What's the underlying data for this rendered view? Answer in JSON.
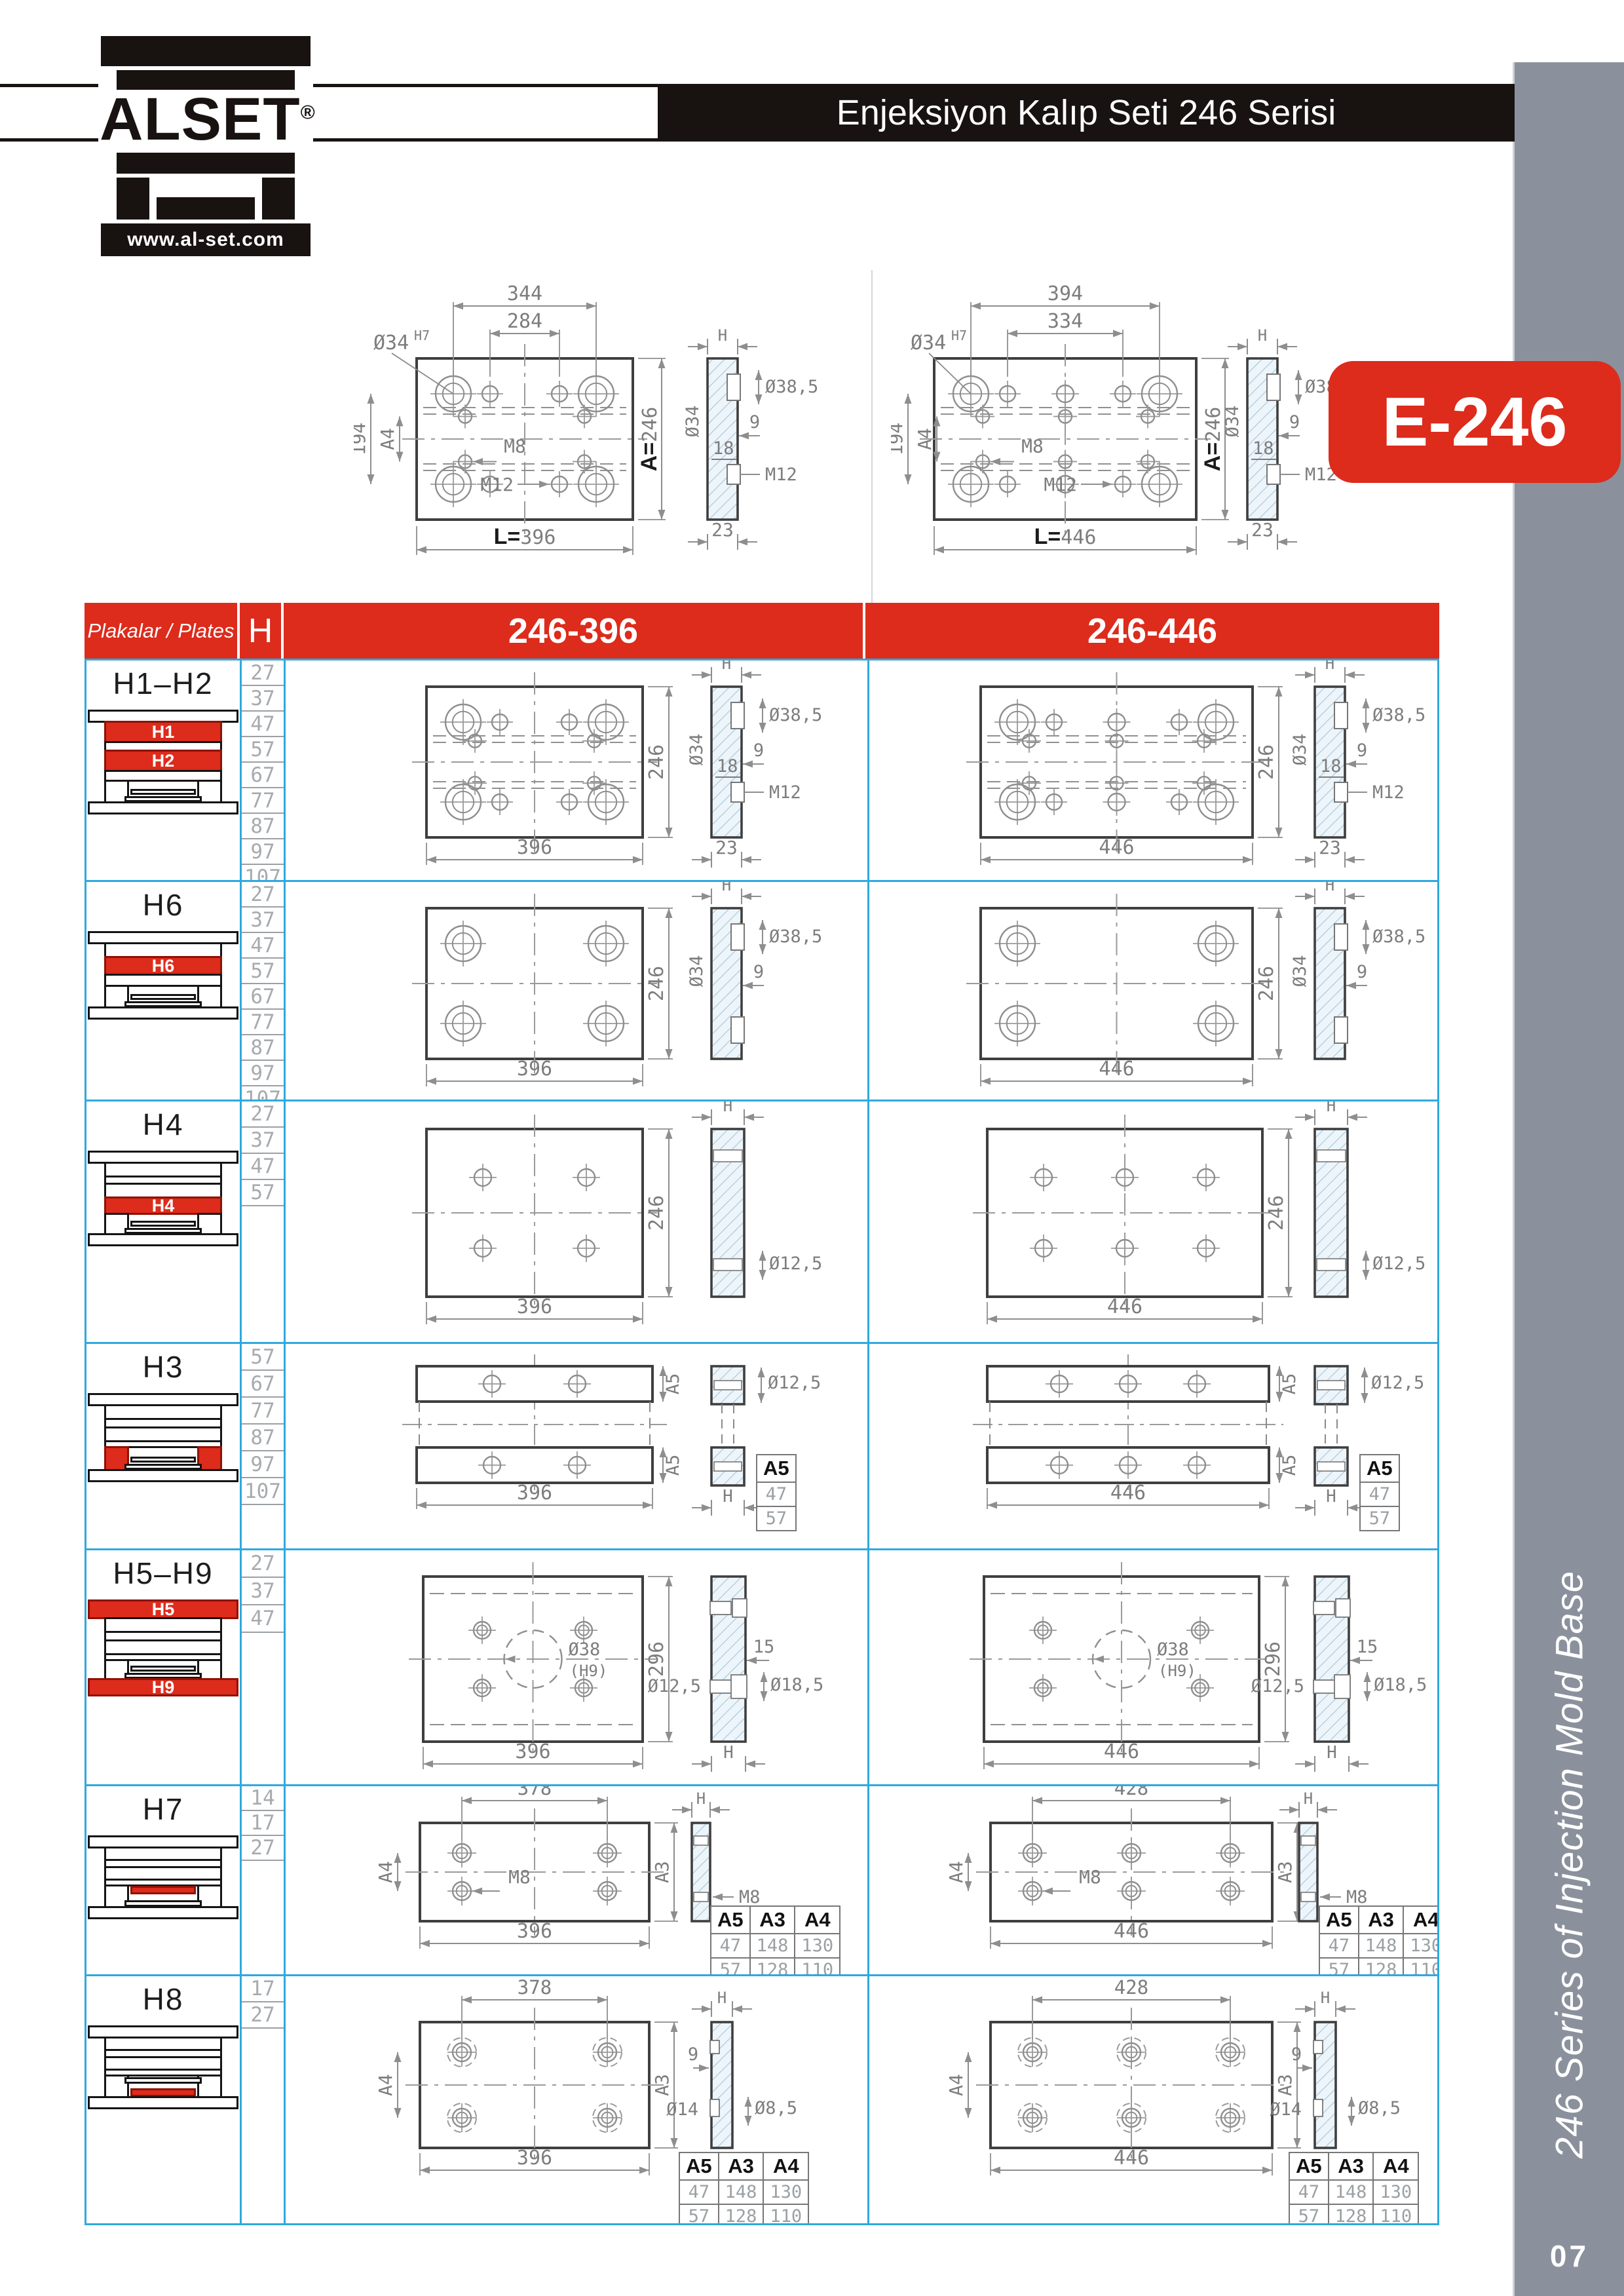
{
  "colors": {
    "red": "#dd2b1c",
    "blue": "#2fa9dd",
    "sidebar_gray": "#8b919c",
    "header_black": "#181210",
    "hatch_line": "#a9cadb",
    "dim_gray": "#7d7d7d"
  },
  "logo": {
    "brand": "ALSET",
    "registered": "®",
    "website": "www.al-set.com"
  },
  "header": {
    "title": "Enjeksiyon Kalıp Seti 246 Serisi",
    "badge": "E-246"
  },
  "sidebar": {
    "vertical_text": "246 Series of Injection Mold Base",
    "page_number": "07"
  },
  "top_drawings": {
    "left": {
      "title_dims": {
        "top": "344",
        "top2": "284",
        "left": "194",
        "left2": "A4",
        "bottom": "L=396",
        "right": "A=246"
      },
      "callout": "Ø34",
      "callout_sup": "H7",
      "m8": "M8",
      "m12": "M12",
      "side": {
        "h": "H",
        "d34": "Ø34",
        "d385": "Ø38,5",
        "n9": "9",
        "n18": "18",
        "m12": "M12",
        "n23": "23"
      }
    },
    "right": {
      "title_dims": {
        "top": "394",
        "top2": "334",
        "left": "194",
        "left2": "A4",
        "bottom": "L=446",
        "right": "A=246"
      },
      "callout": "Ø34",
      "callout_sup": "H7",
      "m8": "M8",
      "m12": "M12",
      "side": {
        "h": "H",
        "d34": "Ø34",
        "d385": "Ø38,5",
        "n9": "9",
        "n18": "18",
        "m12": "M12",
        "n23": "23"
      }
    }
  },
  "table": {
    "header": {
      "plates": "Plakalar / Plates",
      "h": "H",
      "col_396": "246-396",
      "col_446": "246-446"
    },
    "rows": [
      {
        "id": "h1h2",
        "title": "H1–H2",
        "h_values": [
          "27",
          "37",
          "47",
          "57",
          "67",
          "77",
          "87",
          "97",
          "107"
        ],
        "icon_labels": [
          "H1",
          "H2"
        ],
        "front": {
          "right": "246",
          "bottom_396": "396",
          "bottom_446": "446"
        },
        "side": {
          "h": "H",
          "d34": "Ø34",
          "d385": "Ø38,5",
          "n9": "9",
          "n18": "18",
          "m12": "M12",
          "n23": "23"
        }
      },
      {
        "id": "h6",
        "title": "H6",
        "h_values": [
          "27",
          "37",
          "47",
          "57",
          "67",
          "77",
          "87",
          "97",
          "107"
        ],
        "icon_labels": [
          "H6"
        ],
        "front": {
          "right": "246",
          "bottom_396": "396",
          "bottom_446": "446"
        },
        "side": {
          "h": "H",
          "d34": "Ø34",
          "d385": "Ø38,5",
          "n9": "9"
        }
      },
      {
        "id": "h4",
        "title": "H4",
        "h_values": [
          "27",
          "37",
          "47",
          "57"
        ],
        "icon_labels": [
          "H4"
        ],
        "front": {
          "right": "246",
          "bottom_396": "396",
          "bottom_446": "446"
        },
        "side": {
          "h": "H",
          "d125": "Ø12,5"
        }
      },
      {
        "id": "h3",
        "title": "H3",
        "h_values": [
          "57",
          "67",
          "77",
          "87",
          "97",
          "107"
        ],
        "icon_labels": [],
        "front": {
          "bar": "A5",
          "bottom_396": "396",
          "bottom_446": "446"
        },
        "side": {
          "h": "H",
          "d125": "Ø12,5"
        },
        "minitable": {
          "headers": [
            "A5"
          ],
          "rows": [
            [
              "47"
            ],
            [
              "57"
            ]
          ]
        }
      },
      {
        "id": "h5h9",
        "title": "H5–H9",
        "h_values": [
          "27",
          "37",
          "47"
        ],
        "icon_labels": [
          "H5",
          "H9"
        ],
        "front": {
          "right": "296",
          "bottom_396": "396",
          "bottom_446": "446",
          "center": "Ø38",
          "center_sub": "(H9)"
        },
        "side": {
          "h": "H",
          "n15": "15",
          "d125": "Ø12,5",
          "d185": "Ø18,5"
        }
      },
      {
        "id": "h7",
        "title": "H7",
        "h_values": [
          "14",
          "17",
          "27"
        ],
        "icon_labels": [],
        "front": {
          "top_396": "378",
          "top_446": "428",
          "left": "A4",
          "right": "A3",
          "m8": "M8",
          "bottom_396": "396",
          "bottom_446": "446"
        },
        "side": {
          "h": "H",
          "m8": "M8"
        },
        "minitable": {
          "headers": [
            "A5",
            "A3",
            "A4"
          ],
          "rows": [
            [
              "47",
              "148",
              "130"
            ],
            [
              "57",
              "128",
              "110"
            ]
          ]
        }
      },
      {
        "id": "h8",
        "title": "H8",
        "h_values": [
          "17",
          "27"
        ],
        "icon_labels": [],
        "front": {
          "top_396": "378",
          "top_446": "428",
          "left": "A4",
          "right": "A3",
          "bottom_396": "396",
          "bottom_446": "446"
        },
        "side": {
          "h": "H",
          "n9": "9",
          "d14": "Ø14",
          "d85": "Ø8,5"
        },
        "minitable": {
          "headers": [
            "A5",
            "A3",
            "A4"
          ],
          "rows": [
            [
              "47",
              "148",
              "130"
            ],
            [
              "57",
              "128",
              "110"
            ]
          ]
        }
      }
    ]
  }
}
